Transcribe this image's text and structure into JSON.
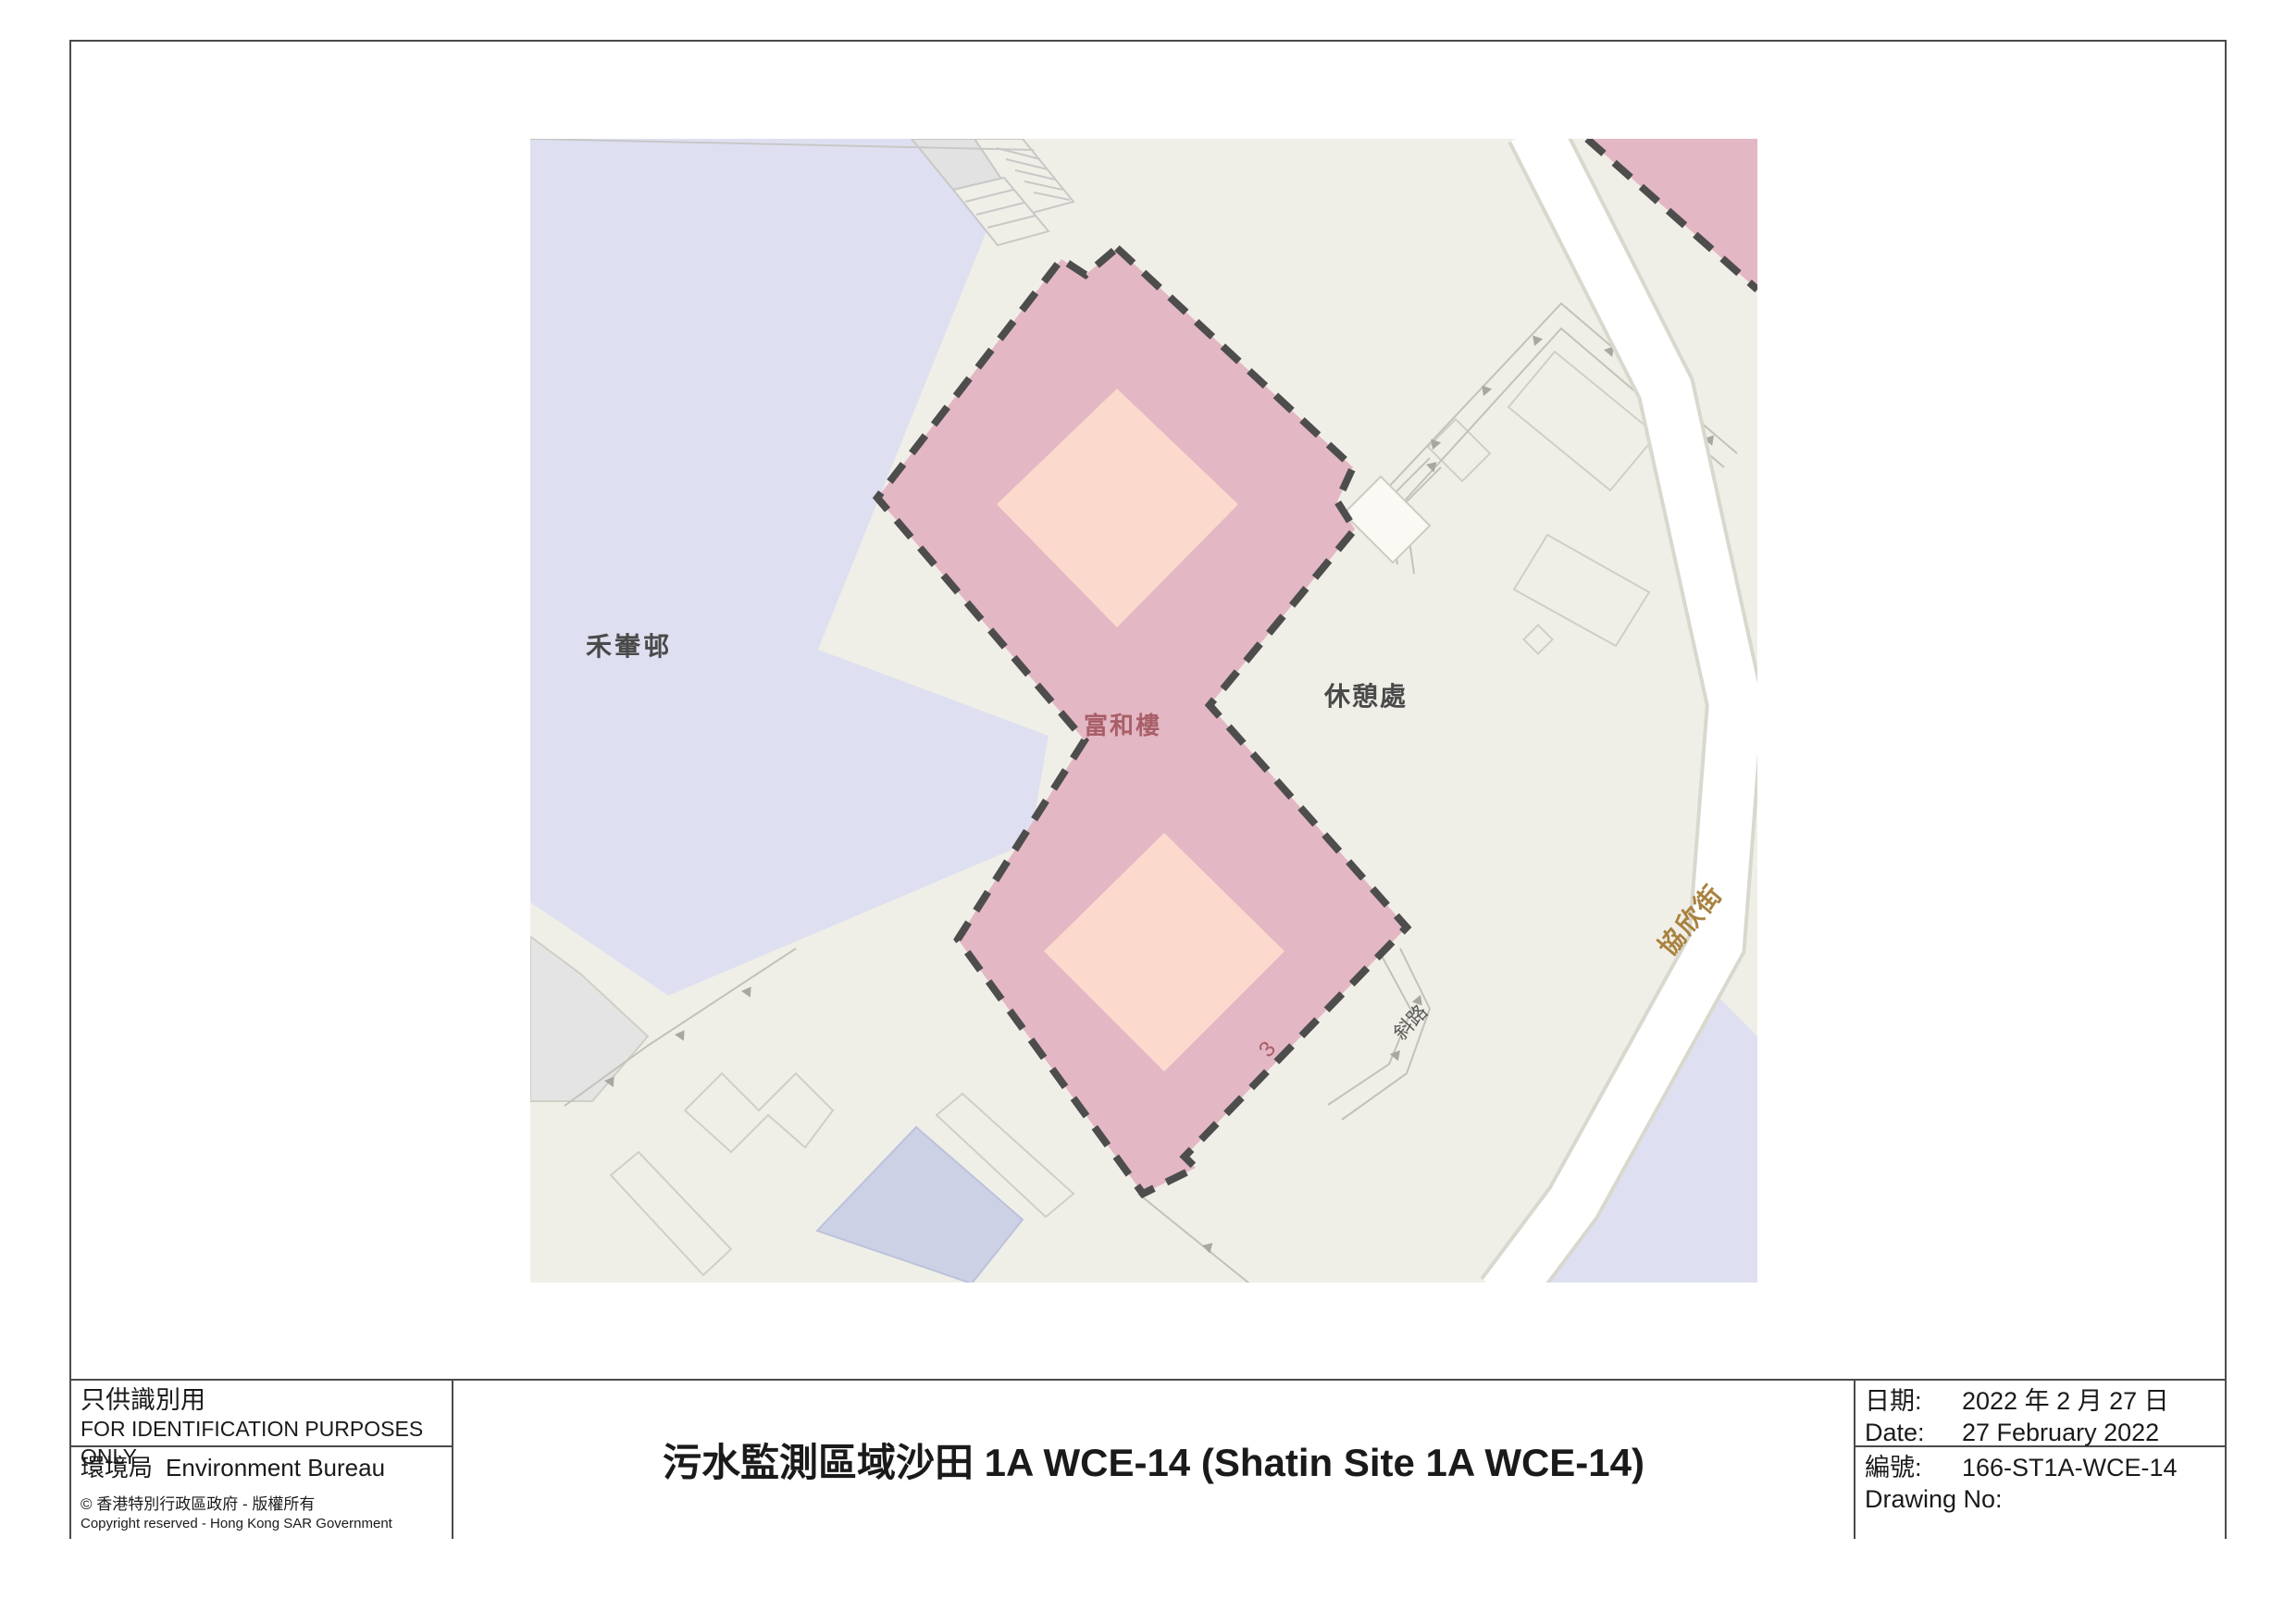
{
  "map": {
    "labels": {
      "wo_che_estate": "禾輋邨",
      "fu_wo_house": "富和樓",
      "rest_area": "休憩處",
      "hip_yan_street": "協欣街",
      "slope": "斜路",
      "block_number": "3"
    },
    "colors": {
      "site_fill": "#e3b7c4",
      "building_fill": "#fbd9cc",
      "site_outline": "#4d4d4d",
      "estate_fill": "#dee0f1",
      "ground_fill": "#f0efe7",
      "road_fill": "#ffffff",
      "street_label": "#a9823f",
      "site_label": "#a85f68"
    }
  },
  "footer": {
    "left": {
      "note_zh": "只供識別用",
      "note_en": "FOR IDENTIFICATION PURPOSES ONLY",
      "bureau_zh": "環境局",
      "bureau_en": "Environment Bureau",
      "copyright_zh": "©  香港特別行政區政府 - 版權所有",
      "copyright_en": "Copyright reserved - Hong Kong SAR Government"
    },
    "title": "污水監測區域沙田 1A WCE-14 (Shatin Site 1A WCE-14)",
    "right": {
      "date_label_zh": "日期:",
      "date_value_zh": "2022 年 2 月 27 日",
      "date_label_en": "Date:",
      "date_value_en": "27 February 2022",
      "no_label_zh": "編號:",
      "no_value": "166-ST1A-WCE-14",
      "no_label_en": "Drawing No:"
    }
  }
}
